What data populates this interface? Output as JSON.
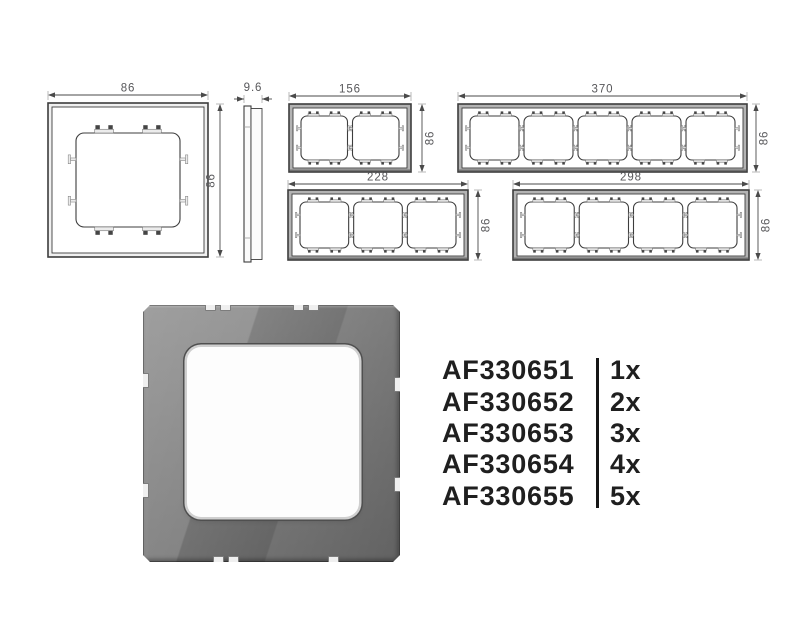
{
  "drawings": {
    "single_frame": {
      "gangs": 1,
      "width": "86",
      "height": "86"
    },
    "side_profile": {
      "depth": "9.6"
    },
    "two_gang": {
      "gangs": 2,
      "width": "156",
      "height": "86"
    },
    "three_gang": {
      "gangs": 3,
      "width": "228",
      "height": "86"
    },
    "four_gang": {
      "gangs": 4,
      "width": "298",
      "height": "86"
    },
    "five_gang": {
      "gangs": 5,
      "width": "370",
      "height": "86"
    }
  },
  "products": [
    {
      "code": "AF330651",
      "qty": "1x"
    },
    {
      "code": "AF330652",
      "qty": "2x"
    },
    {
      "code": "AF330653",
      "qty": "3x"
    },
    {
      "code": "AF330654",
      "qty": "4x"
    },
    {
      "code": "AF330655",
      "qty": "5x"
    }
  ],
  "colors": {
    "outline": "#3d3d3d",
    "dim_line": "#4a4a4a",
    "ext_line": "#9c9c9c",
    "dim_text": "#57575a",
    "band_single": "#f0f0f0",
    "band_multi": "#b3b3b3",
    "clip_dark": "#454545",
    "clip_light": "#ececec",
    "clip_stroke": "#777777",
    "photo_gray": "#878787",
    "code_text": "#1f1f1f",
    "divider": "#161616"
  }
}
